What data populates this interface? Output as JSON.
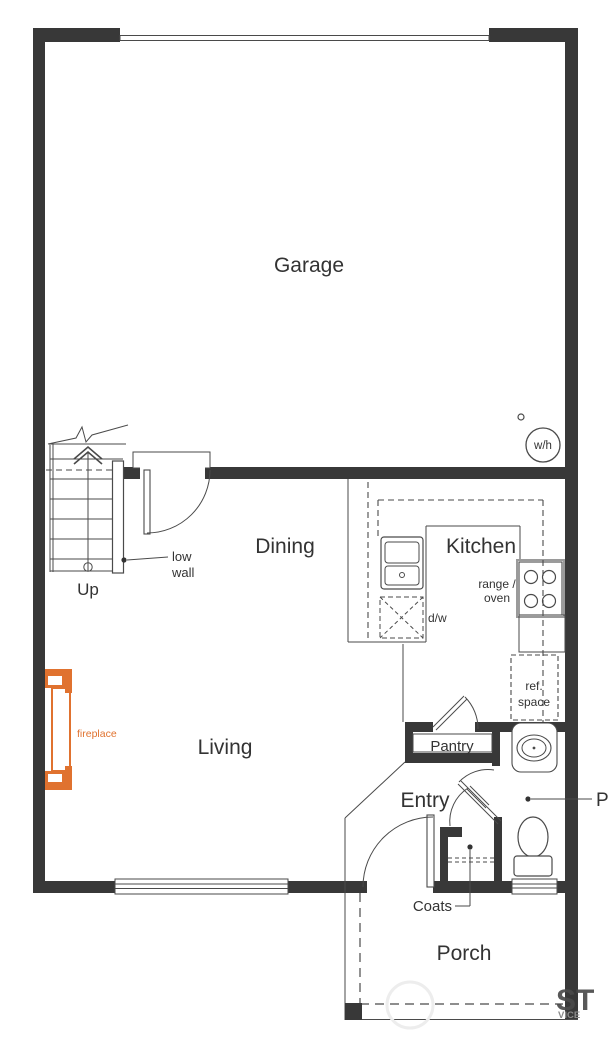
{
  "rooms": {
    "garage": "Garage",
    "dining": "Dining",
    "kitchen": "Kitchen",
    "living": "Living",
    "entry": "Entry",
    "pantry": "Pantry",
    "porch": "Porch"
  },
  "labels": {
    "up": "Up",
    "low_wall_line1": "low",
    "low_wall_line2": "wall",
    "water_heater": "w/h",
    "range_oven_line1": "range /",
    "range_oven_line2": "oven",
    "ref_space_line1": "ref.",
    "ref_space_line2": "space",
    "dishwasher": "d/w",
    "fireplace": "fireplace",
    "coats": "Coats",
    "powder_partial": "P"
  },
  "watermark": {
    "line1": "ST",
    "line2": "VICE"
  },
  "colors": {
    "wall": "#383838",
    "line": "#4a4a4a",
    "text": "#333333",
    "fireplace_accent": "#e0722f",
    "watermark": "#555555",
    "background": "#ffffff"
  }
}
